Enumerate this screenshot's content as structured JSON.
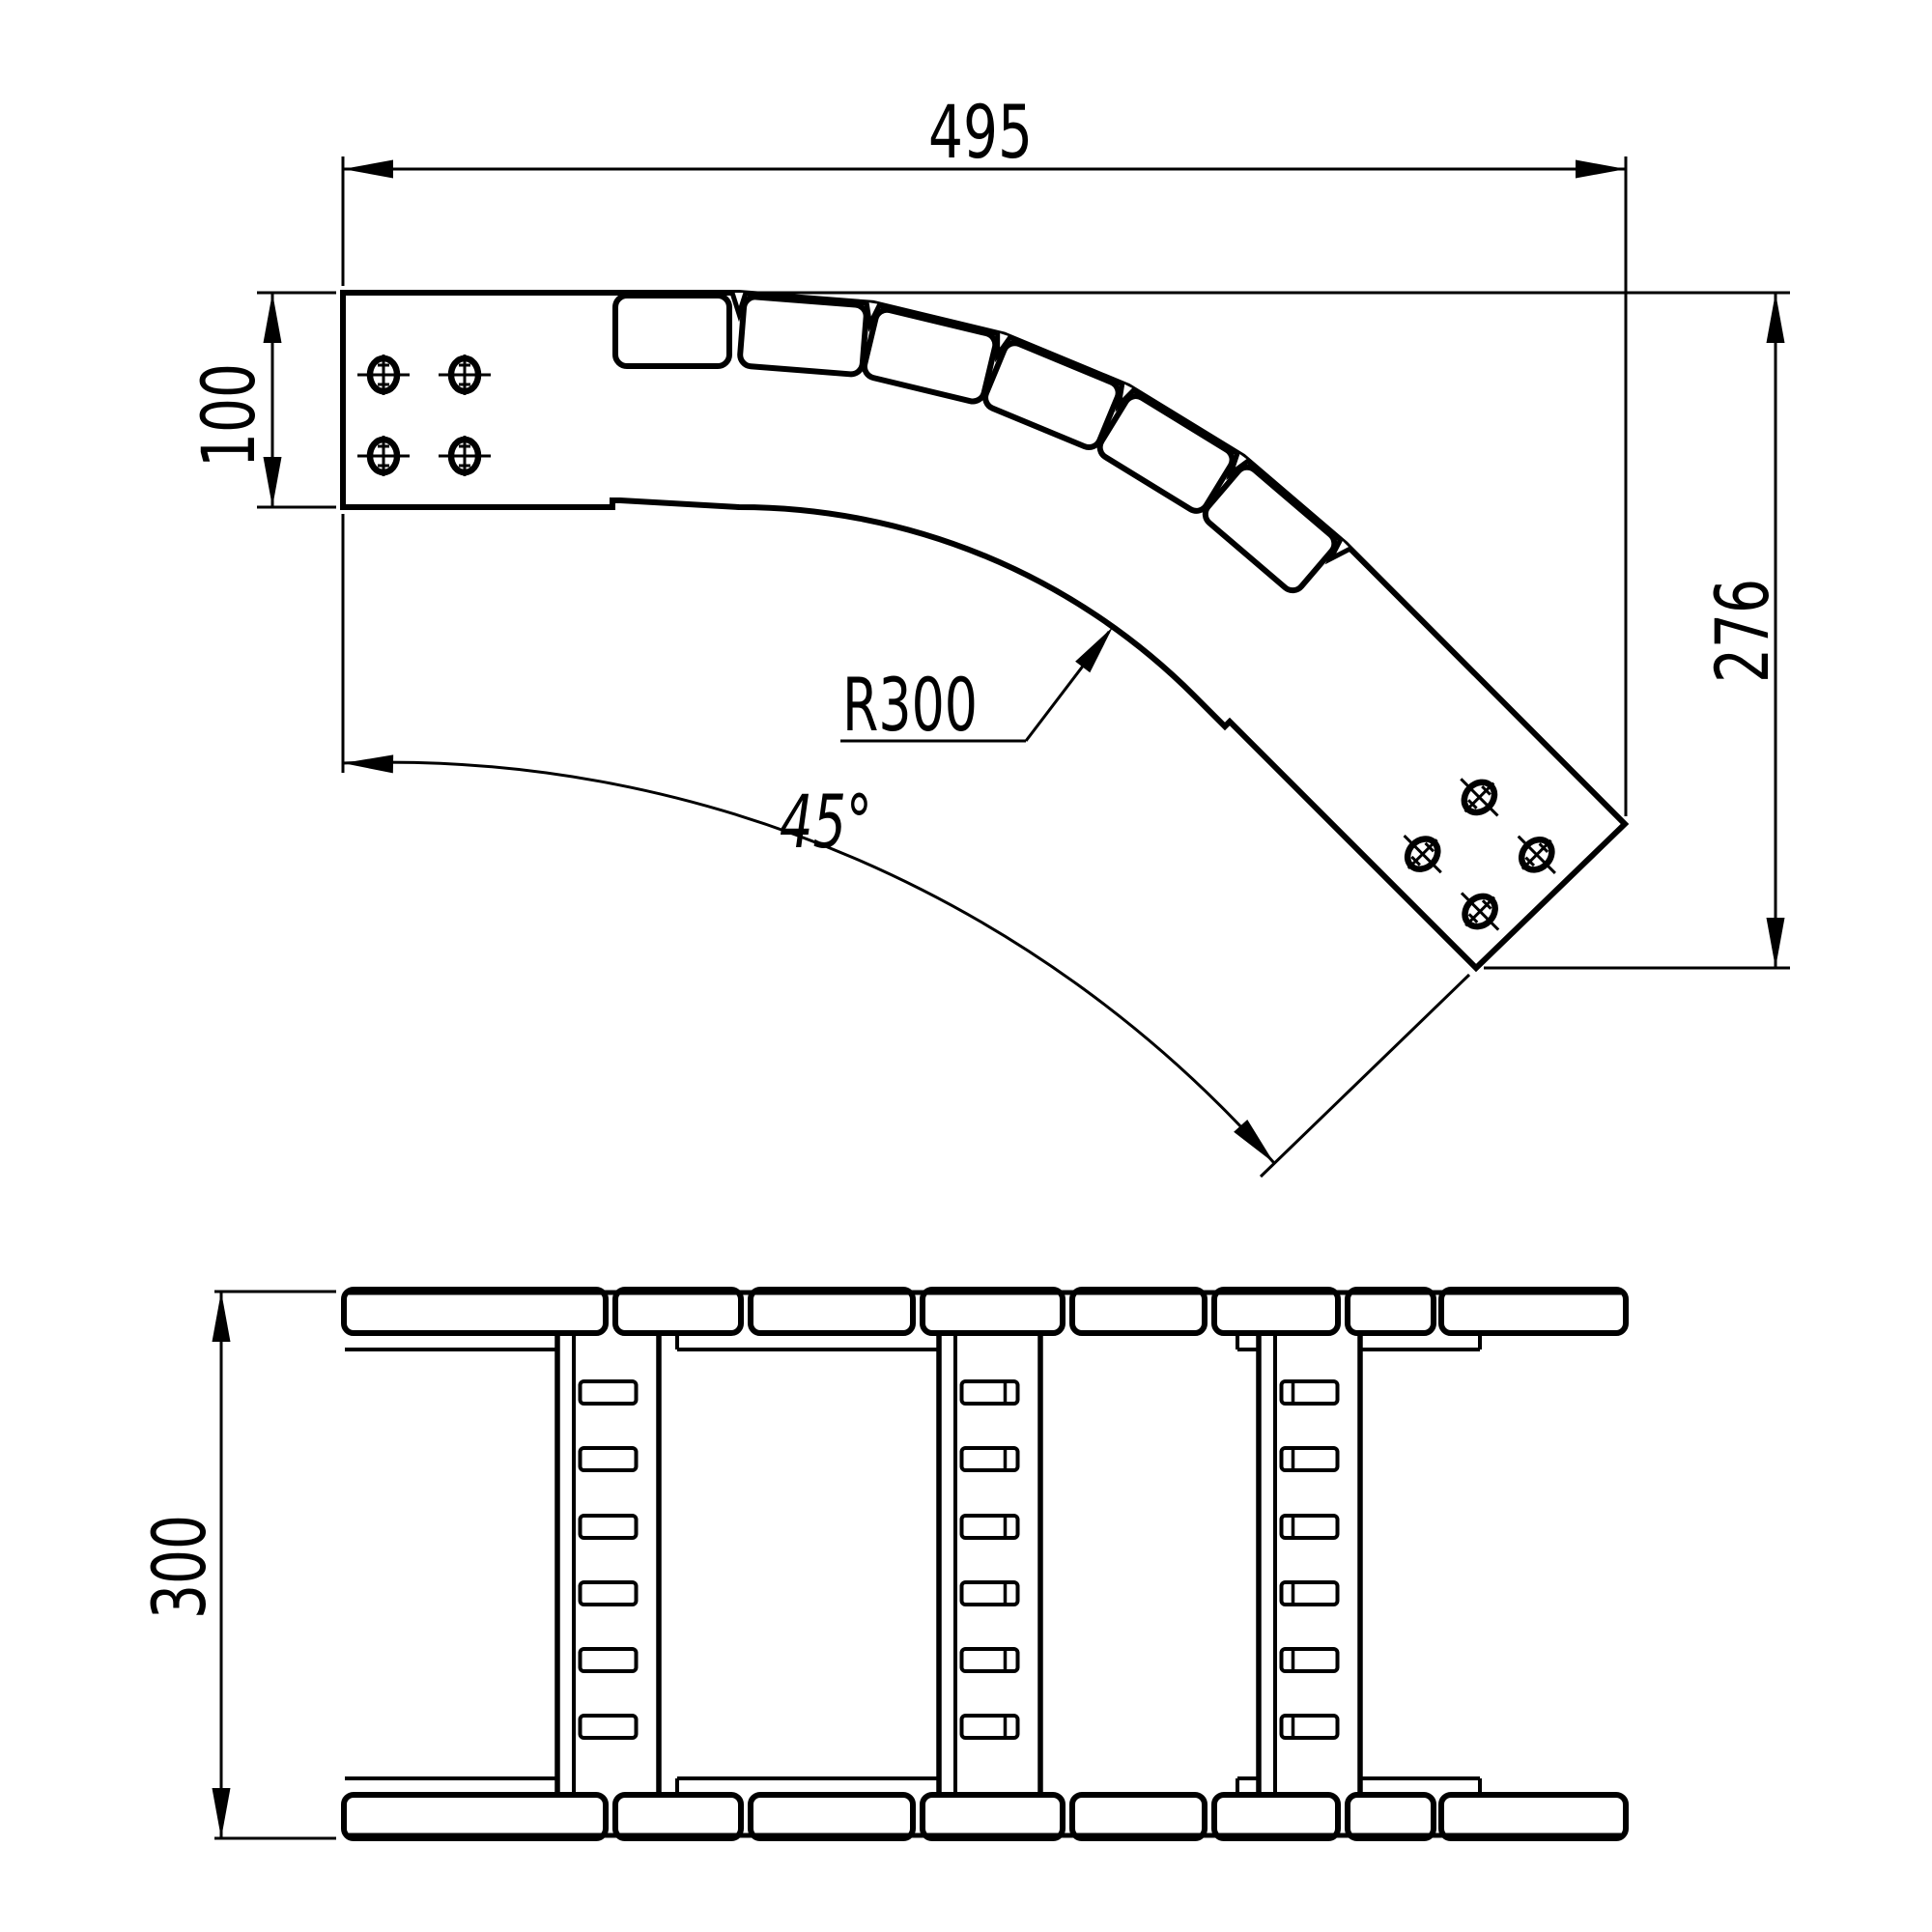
{
  "labels": {
    "dim_width": "495",
    "dim_rail_height": "100",
    "dim_radius": "R300",
    "dim_angle": "45°",
    "dim_height": "276",
    "dim_tray_width": "300"
  },
  "drawing": {
    "type": "technical-2d-cad-drawing",
    "subject": "45-degree adjustable cable ladder bend",
    "background_color": "#ffffff",
    "line_color": "#000000",
    "top_view": {
      "name": "plan-view-45-degree-bend",
      "bend_angle_deg": 45,
      "plate_count": 6,
      "notch_count": 6,
      "slot_holes_per_end": 4
    },
    "bottom_view": {
      "name": "developed-elevation-view",
      "rail_segment_count": 8,
      "rung_count": 3,
      "slots_per_rung": 6
    }
  }
}
